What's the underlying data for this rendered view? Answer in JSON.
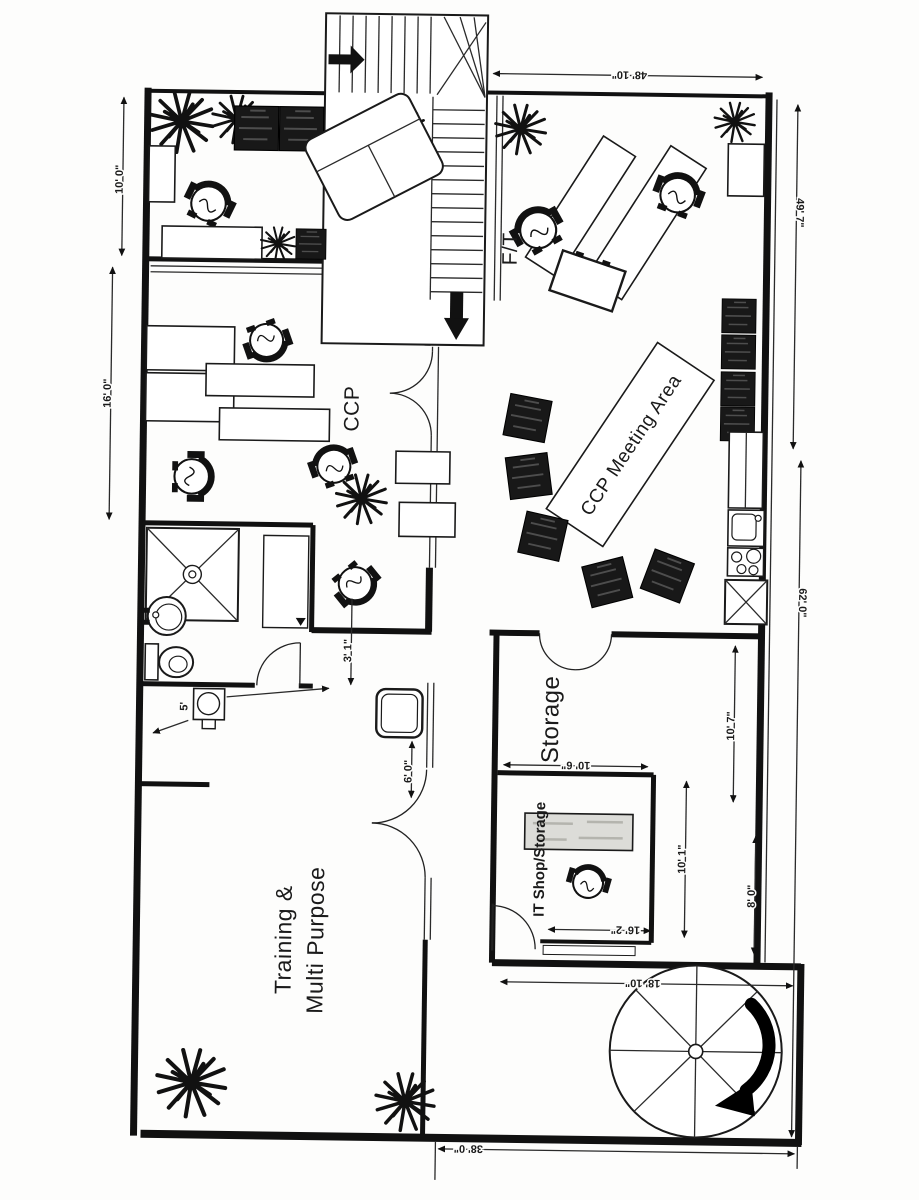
{
  "plan": {
    "rooms": {
      "ft": "F/T",
      "ccp": "CCP",
      "meeting": "CCP Meeting Area",
      "storage": "Storage",
      "it_shop": "IT Shop/Storage",
      "training_1": "Training &",
      "training_2": "Multi Purpose"
    },
    "dimensions": {
      "left_upper": "10' 0\"",
      "left_mid": "16' 0\"",
      "top_right": "48' 10\"",
      "right_upper": "49' 7\"",
      "right_mid": "62' 0\"",
      "storage_height": "10' 7\"",
      "it_width": "10' 6\"",
      "store_right_h": "10' 1\"",
      "store_right_w": "8' 0\"",
      "it_bottom": "16' 2\"",
      "stair_room": "18' 10\"",
      "corridor": "3' 1\"",
      "door": "6' 0\"",
      "utility": "5'",
      "bottom": "38' 0\""
    },
    "colors": {
      "ink": "#1a1a1a",
      "paper": "#ffffff"
    }
  }
}
